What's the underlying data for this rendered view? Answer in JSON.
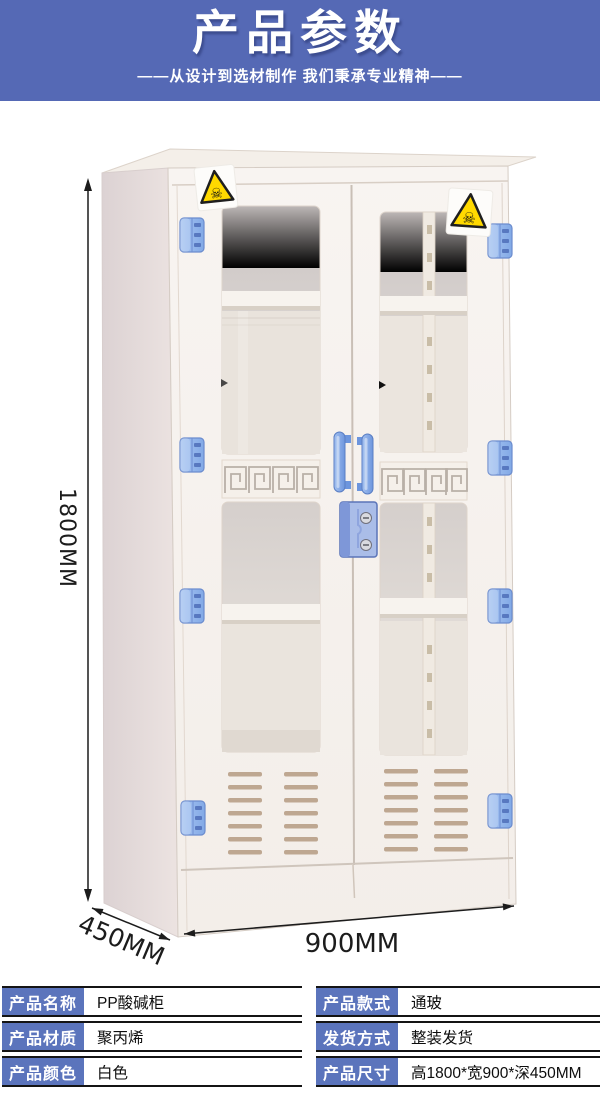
{
  "header": {
    "title": "产品参数",
    "subtitle": "——从设计到选材制作 我们秉承专业精神——",
    "bg_color": "#5569b5"
  },
  "figure": {
    "height_label": "1800MM",
    "width_label": "900MM",
    "depth_label": "450MM",
    "hazard_icon": "toxic-skull-warning",
    "hazard_glyph": "☠",
    "colors": {
      "cabinet_body": "#f6f2ee",
      "cabinet_side": "#e2d8d8",
      "hinge_blue": "#8fb4ea",
      "handle_blue": "#7fa3e8",
      "lock_blue": "#aabde8",
      "warning_yellow": "#ffd900"
    }
  },
  "spec_table": {
    "label_bg": "#5b74bc",
    "left_rows": [
      {
        "label": "产品名称",
        "value": "PP酸碱柜"
      },
      {
        "label": "产品材质",
        "value": "聚丙烯"
      },
      {
        "label": "产品颜色",
        "value": "白色"
      }
    ],
    "right_rows": [
      {
        "label": "产品款式",
        "value": "通玻"
      },
      {
        "label": "发货方式",
        "value": "整装发货"
      },
      {
        "label": "产品尺寸",
        "value": "高1800*宽900*深450MM"
      }
    ]
  }
}
